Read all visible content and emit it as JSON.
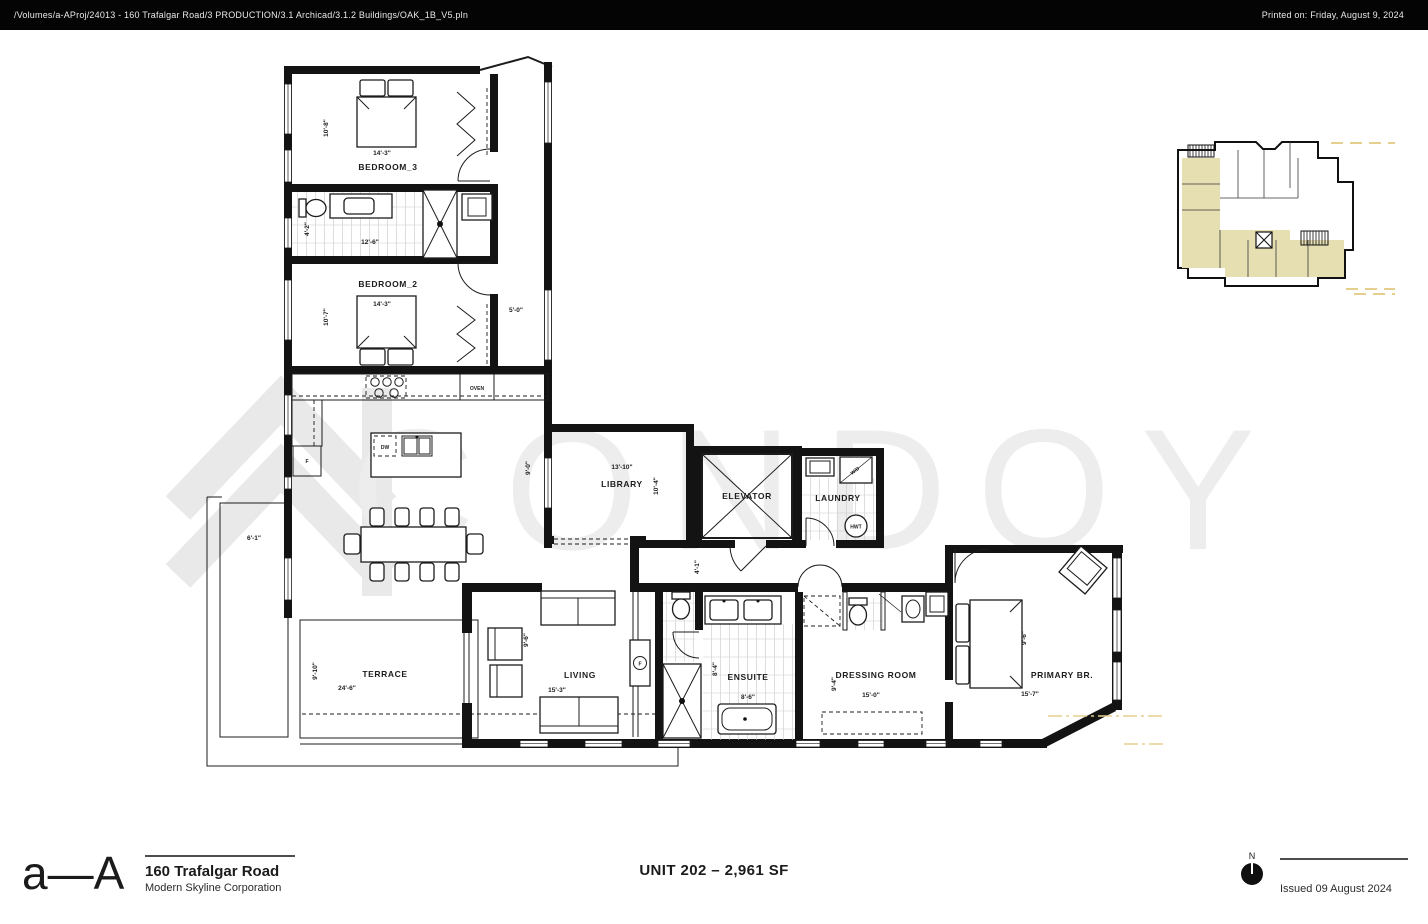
{
  "header": {
    "file_path": "/Volumes/a-AProj/24013 - 160 Trafalgar Road/3 PRODUCTION/3.1 Archicad/3.1.2 Buildings/OAK_1B_V5.pln",
    "printed_on": "Printed on: Friday, August 9, 2024"
  },
  "watermark": {
    "text": "CONDOY"
  },
  "plan": {
    "bedroom3": {
      "label": "BEDROOM_3",
      "dim_w": "14'-3\"",
      "dim_h": "10'-8\""
    },
    "bath2": {
      "dim_w": "12'-6\"",
      "dim_h": "4'-2\""
    },
    "bedroom2": {
      "label": "BEDROOM_2",
      "dim_w": "14'-3\"",
      "dim_h": "10'-7\""
    },
    "corridor": {
      "dim": "5'-0\""
    },
    "kitchen": {
      "dim_h": "9'-0\"",
      "oven": "OVEN",
      "dw": "DW",
      "fridge": "F"
    },
    "library": {
      "label": "LIBRARY",
      "dim_w": "13'-10\"",
      "dim_h": "10'-4\""
    },
    "elevator": {
      "label": "ELEVATOR"
    },
    "laundry": {
      "label": "LAUNDRY",
      "wd": "W/D",
      "hwt": "HWT"
    },
    "hall": {
      "dim": "4'-1\""
    },
    "living": {
      "label": "LIVING",
      "dim_w": "15'-3\"",
      "dim_h": "9'-6\"",
      "fireplace": "F"
    },
    "ensuite": {
      "label": "ENSUITE",
      "dim_w": "8'-6\"",
      "dim_h": "8'-4\""
    },
    "dressing": {
      "label": "DRESSING ROOM",
      "dim_w": "15'-0\"",
      "dim_h": "9'-4\""
    },
    "primary": {
      "label": "PRIMARY BR.",
      "dim_w": "15'-7\"",
      "dim_bed": "9'-6\""
    },
    "terrace": {
      "label": "TERRACE",
      "dim_w": "24'-6\"",
      "dim_h": "9'-10\""
    },
    "planter": {
      "dim": "6'-1\""
    }
  },
  "footer": {
    "logo": "a—A",
    "project": "160 Trafalgar Road",
    "developer": "Modern Skyline Corporation",
    "unit": "UNIT 202 – 2,961 SF",
    "north": "N",
    "issued": "Issued 09 August 2024"
  },
  "colors": {
    "watermark_text": "#ededed",
    "watermark_logo": "#e9e9e9",
    "keyplan_highlight": "#e6dfb2",
    "keyplan_dash": "#e5cf8f",
    "topbar_bg": "#040404"
  }
}
